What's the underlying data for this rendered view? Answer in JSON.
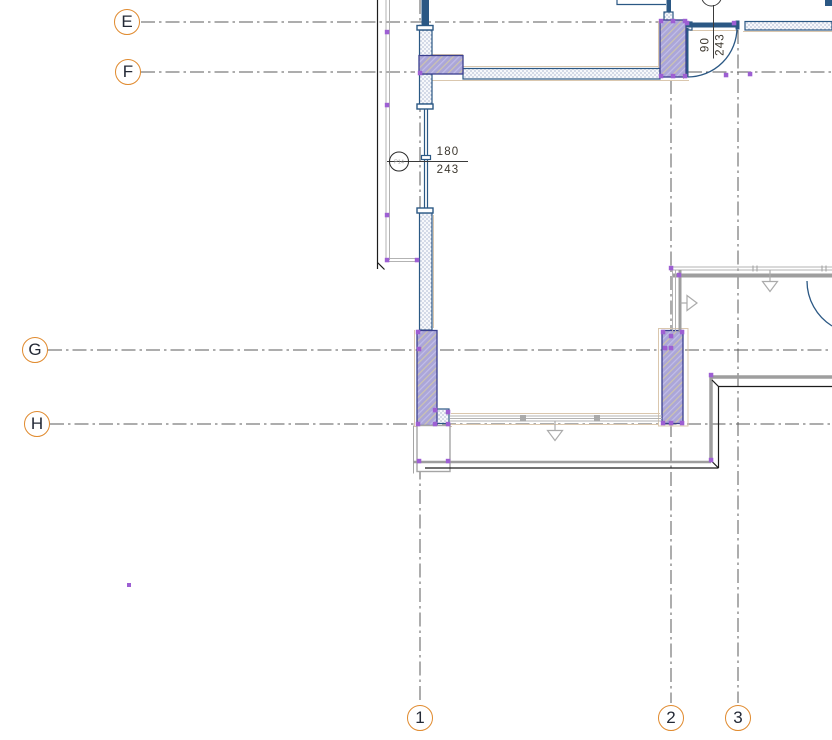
{
  "app": {
    "view_name": "floor-plan-detail"
  },
  "drawing": {
    "grid": {
      "row_bubbles": [
        {
          "label": "E"
        },
        {
          "label": "F"
        },
        {
          "label": "G"
        },
        {
          "label": "H"
        }
      ],
      "col_bubbles": [
        {
          "label": "1"
        },
        {
          "label": "2"
        },
        {
          "label": "3"
        }
      ]
    },
    "dimensions": {
      "window_dim": {
        "width": "180",
        "under": "243"
      },
      "door_dim": {
        "width": "90",
        "under": "243"
      }
    },
    "tags": {
      "window_tag": "P14"
    },
    "colors": {
      "grid_bubble_stroke": "#E08A2E",
      "grid_line": "#5B5B5B",
      "wall_navy": "#2B5884",
      "column_fill": "#ABA6D8",
      "column_border": "#3A3F8F",
      "snap_point": "#9D5FD3",
      "tan_outline": "#DAC7AE",
      "gray_wall": "#9E9E9E",
      "dim_text": "#3D382F"
    }
  }
}
